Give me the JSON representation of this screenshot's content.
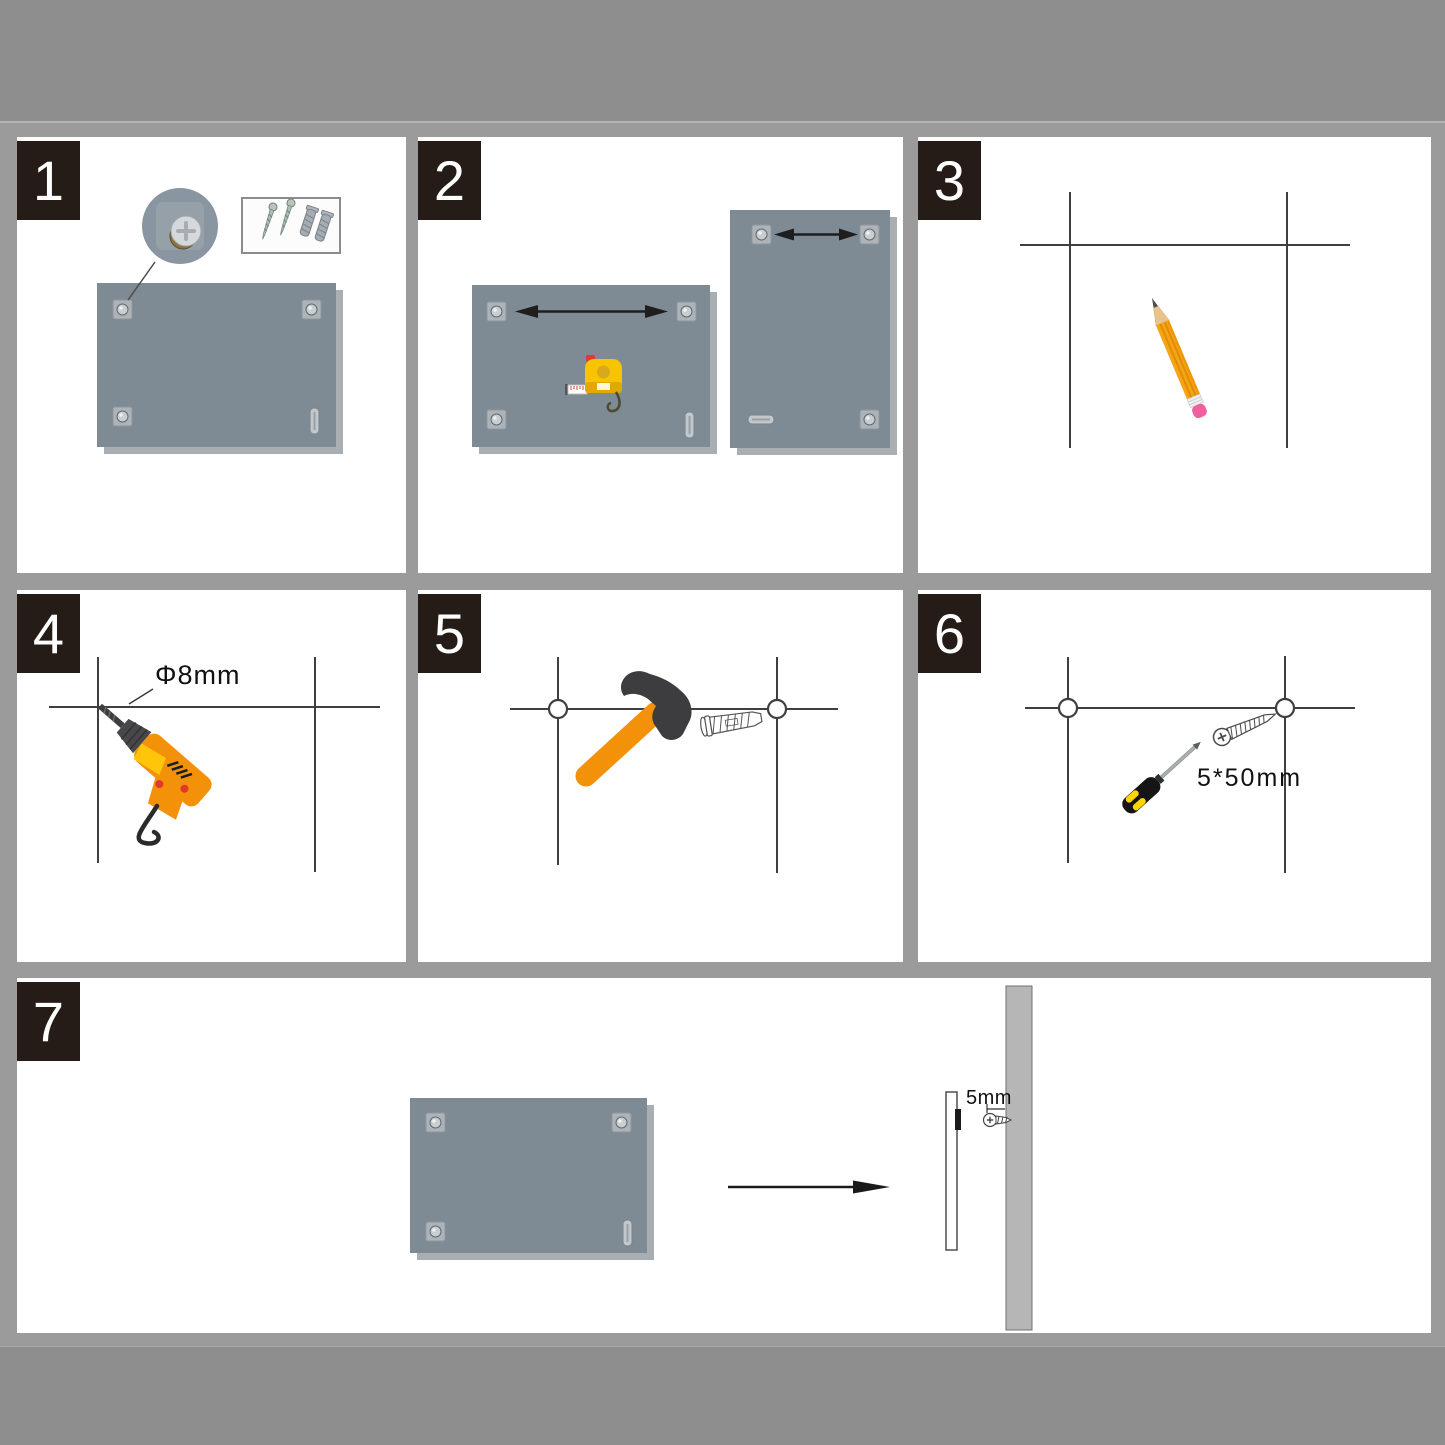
{
  "document": {
    "kind": "wall-mounting-instruction-sheet",
    "panel_count": 7
  },
  "steps": [
    {
      "number": "1",
      "icons": [
        "mounting-board",
        "corner-fixing-magnifier",
        "screws-and-anchors-box"
      ]
    },
    {
      "number": "2",
      "icons": [
        "tape-measure-icon",
        "landscape-board",
        "portrait-board",
        "measure-arrows"
      ]
    },
    {
      "number": "3",
      "icons": [
        "pencil-icon",
        "marking-lines"
      ]
    },
    {
      "number": "4",
      "icons": [
        "drill-icon",
        "marking-lines"
      ]
    },
    {
      "number": "5",
      "icons": [
        "hammer-icon",
        "wall-anchor-icon",
        "drill-holes"
      ]
    },
    {
      "number": "6",
      "icons": [
        "screwdriver-icon",
        "screw-icon",
        "drill-holes"
      ]
    },
    {
      "number": "7",
      "icons": [
        "mounting-board",
        "direction-arrow",
        "wall-side-view",
        "mounting-screw-icon"
      ]
    }
  ],
  "labels": {
    "drill_diameter": "Φ8mm",
    "screw_size": "5*50mm",
    "wall_gap": "5mm"
  },
  "colors": {
    "page_background": "#8e8e8e",
    "sheet_background": "#9b9b9b",
    "panel_background": "#ffffff",
    "step_badge": "#261c17",
    "board_gray": "#7e8a94",
    "accent_orange": "#f39208",
    "tool_dark": "#3d3d40",
    "marking_line": "#3f3f3f",
    "tape_yellow": "#f8c400",
    "eraser_pink": "#f0609f"
  },
  "icons": {
    "tape-measure-icon": "yellow tape measure body with white blade",
    "pencil-icon": "orange pencil with pink eraser",
    "drill-icon": "orange electric drill with dark bit",
    "hammer-icon": "claw hammer with orange handle",
    "wall-anchor-icon": "outlined expansion plug",
    "screw-icon": "outlined phillips screw",
    "screwdriver-icon": "black and yellow screwdriver",
    "direction-arrow": "black right arrow",
    "measure-arrows": "double headed arrows",
    "corner-fixing-magnifier": "circular zoom of corner screw pad"
  }
}
